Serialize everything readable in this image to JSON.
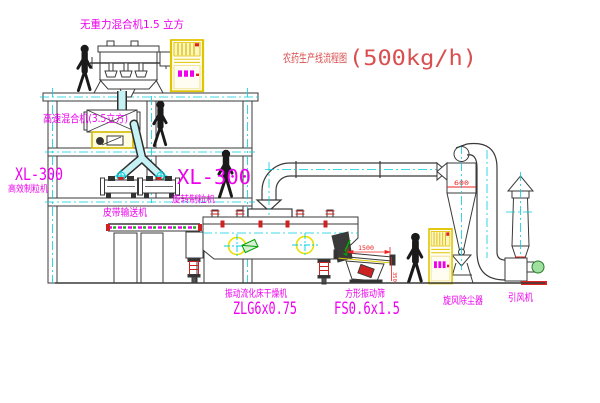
{
  "diagram": {
    "title": "农药生产线流程图",
    "capacity": "(500kg/h)"
  },
  "labels": {
    "gravity_mixer": "无重力混合机1.5 立方",
    "high_speed_mixer": "高速混合机(3.5立方)",
    "granulator_left_model": "XL-300",
    "granulator_left_name": "高效制粒机",
    "granulator_right_model": "XL-300",
    "granulator_right_name": "旋转制粒机",
    "belt_conveyor": "皮带输送机",
    "dryer_name": "振动流化床干燥机",
    "dryer_model": "ZLG6x0.75",
    "screen_name": "方形振动筛",
    "screen_model": "FS0.6x1.5",
    "cyclone_name": "旋风除尘器",
    "fan_name": "引风机"
  },
  "dimensions": {
    "screen_length": "1500",
    "screen_height": "350",
    "cyclone_diameter": "600"
  },
  "colors": {
    "label_magenta": "#ee00ee",
    "title_red": "#d94f4f",
    "dimension_red": "#ee2222",
    "structure_yellow": "#e0c400",
    "centerline_cyan": "#00cfdc",
    "line_dark": "#3a3a3a"
  }
}
